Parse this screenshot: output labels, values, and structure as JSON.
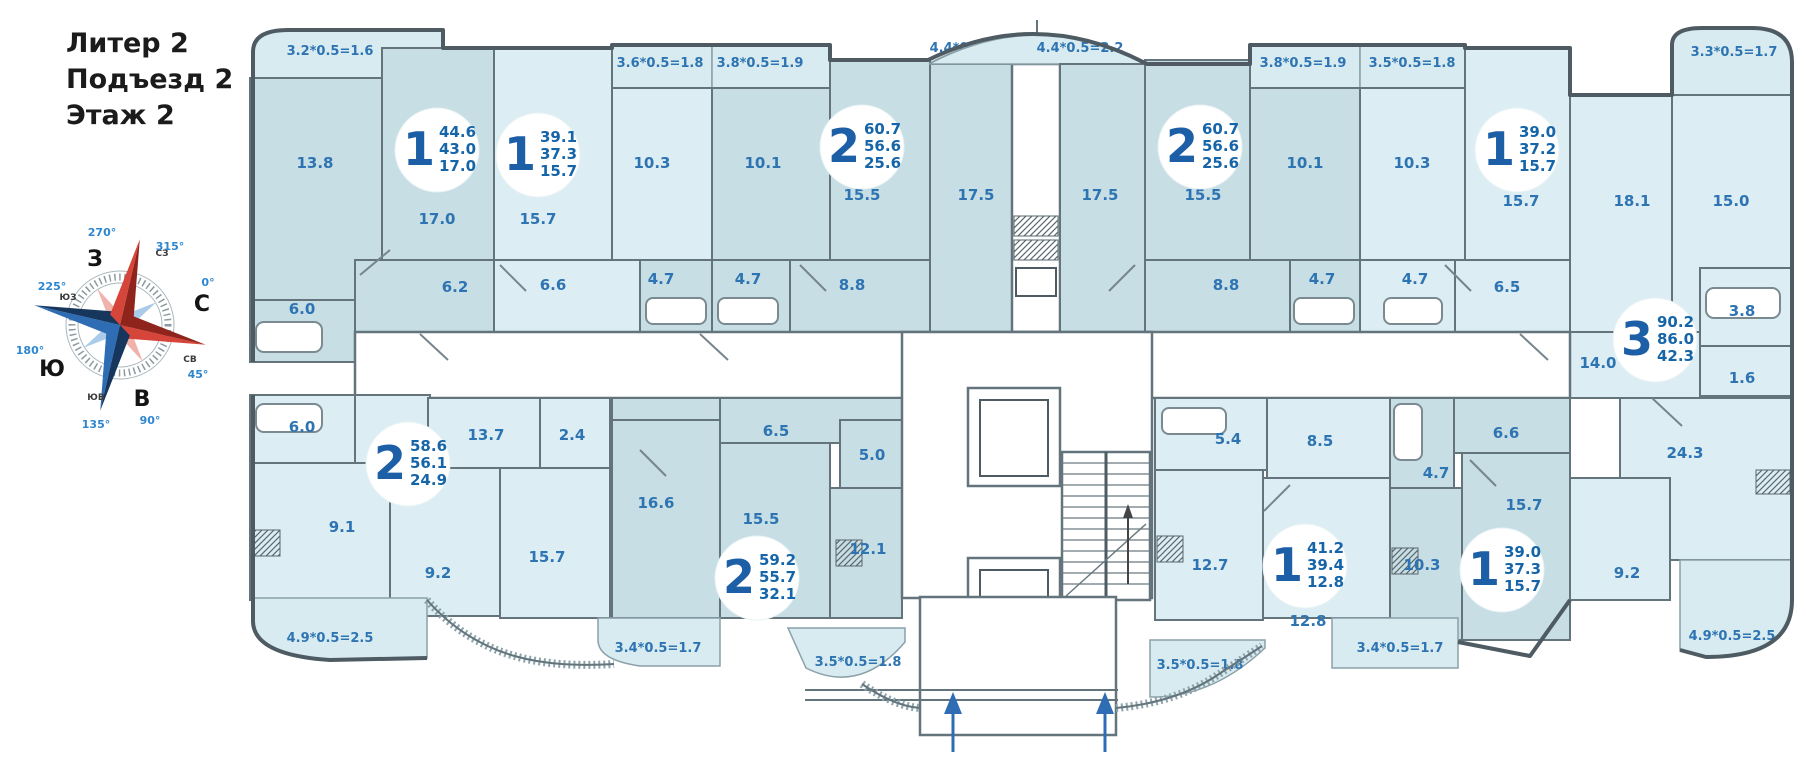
{
  "page": {
    "title_lines": [
      "Литер 2",
      "Подъезд 2",
      "Этаж 2"
    ]
  },
  "compass": {
    "cardinals": {
      "n": "С",
      "e": "В",
      "s": "Ю",
      "w": "З"
    },
    "intercardinals": {
      "ne": "СВ",
      "se": "ЮВ",
      "sw": "ЮЗ",
      "nw": "СЗ"
    },
    "degrees": {
      "d0": "0°",
      "d45": "45°",
      "d90": "90°",
      "d135": "135°",
      "d180": "180°",
      "d225": "225°",
      "d270": "270°",
      "d315": "315°"
    }
  },
  "colors": {
    "label_blue": "#2e74b2",
    "badge_blue": "#1d5fa6",
    "room_dark": "#c6dee4",
    "room_light": "#dceef3",
    "arrow_blue": "#2e6db4"
  },
  "apartments": [
    {
      "badge": "1",
      "areas": {
        "total": "44.6",
        "net": "43.0",
        "living": "17.0"
      },
      "rooms": [
        "13.8",
        "17.0",
        "6.2",
        "6.0"
      ],
      "balconies": [
        "3.2*0.5=1.6"
      ]
    },
    {
      "badge": "1",
      "areas": {
        "total": "39.1",
        "net": "37.3",
        "living": "15.7"
      },
      "rooms": [
        "15.7",
        "10.3",
        "6.6",
        "4.7"
      ],
      "balconies": [
        "3.6*0.5=1.8"
      ]
    },
    {
      "badge": "2",
      "areas": {
        "total": "60.7",
        "net": "56.6",
        "living": "25.6"
      },
      "rooms": [
        "10.1",
        "15.5",
        "17.5",
        "4.7",
        "8.8"
      ],
      "balconies": [
        "3.8*0.5=1.9",
        "4.4*0.5=2.2"
      ]
    },
    {
      "badge": "2",
      "areas": {
        "total": "60.7",
        "net": "56.6",
        "living": "25.6"
      },
      "rooms": [
        "17.5",
        "15.5",
        "10.1",
        "8.8",
        "4.7"
      ],
      "balconies": [
        "4.4*0.5=2.2",
        "3.8*0.5=1.9"
      ]
    },
    {
      "badge": "1",
      "areas": {
        "total": "39.0",
        "net": "37.2",
        "living": "15.7"
      },
      "rooms": [
        "10.3",
        "15.7",
        "4.7",
        "6.5"
      ],
      "balconies": [
        "3.5*0.5=1.8"
      ]
    },
    {
      "badge": "3",
      "areas": {
        "total": "90.2",
        "net": "86.0",
        "living": "42.3"
      },
      "rooms": [
        "18.1",
        "15.0",
        "3.8",
        "14.0",
        "1.6",
        "24.3",
        "9.2"
      ],
      "balconies": [
        "3.3*0.5=1.7",
        "4.9*0.5=2.5"
      ]
    },
    {
      "badge": "2",
      "areas": {
        "total": "58.6",
        "net": "56.1",
        "living": "24.9"
      },
      "rooms": [
        "6.0",
        "13.7",
        "2.4",
        "9.1",
        "9.2",
        "15.7"
      ],
      "balconies": [
        "4.9*0.5=2.5"
      ]
    },
    {
      "badge": "2",
      "areas": {
        "total": "59.2",
        "net": "55.7",
        "living": "32.1"
      },
      "rooms": [
        "6.5",
        "16.6",
        "15.5",
        "5.0",
        "12.1"
      ],
      "balconies": [
        "3.4*0.5=1.7",
        "3.5*0.5=1.8"
      ]
    },
    {
      "badge": "1",
      "areas": {
        "total": "41.2",
        "net": "39.4",
        "living": "12.8"
      },
      "rooms": [
        "5.4",
        "8.5",
        "12.7",
        "12.8"
      ],
      "balconies": [
        "3.5*0.5=1.8"
      ]
    },
    {
      "badge": "1",
      "areas": {
        "total": "39.0",
        "net": "37.3",
        "living": "15.7"
      },
      "rooms": [
        "6.6",
        "4.7",
        "10.3",
        "15.7"
      ],
      "balconies": [
        "3.4*0.5=1.7"
      ]
    }
  ]
}
